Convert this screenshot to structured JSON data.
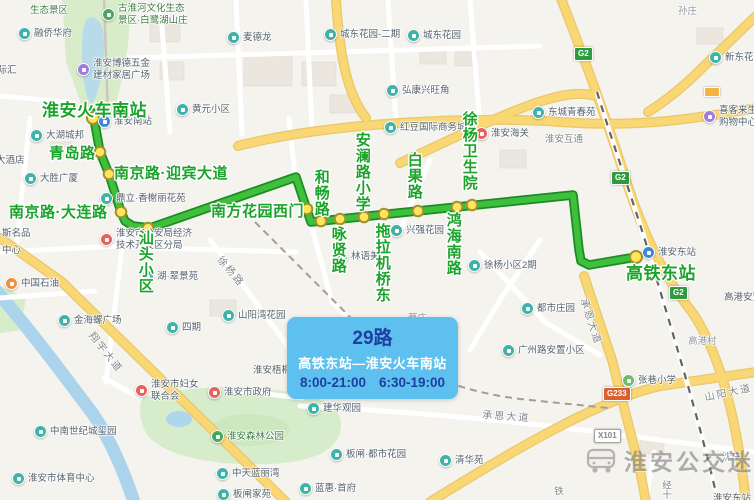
{
  "info_box": {
    "line_name": "29路",
    "route": "高铁东站—淮安火车南站",
    "hours_left": "8:00-21:00",
    "hours_right": "6:30-19:00"
  },
  "watermark": {
    "text": "淮安公交迷"
  },
  "map": {
    "route": {
      "color": "#3fbf3c",
      "casing": "#1a8c24",
      "stop_fill": "#ffe55c",
      "stop_border": "#a2922e",
      "path_points": [
        [
          93,
          113
        ],
        [
          100,
          152
        ],
        [
          109,
          174
        ],
        [
          121,
          212
        ],
        [
          125,
          221
        ],
        [
          133,
          226
        ],
        [
          150,
          228
        ],
        [
          296,
          177
        ],
        [
          311,
          222
        ],
        [
          573,
          195
        ],
        [
          579,
          250
        ],
        [
          581,
          261
        ],
        [
          589,
          265
        ],
        [
          636,
          257
        ]
      ],
      "stops": [
        {
          "name": "淮安火车南站",
          "x": 93,
          "y": 118
        },
        {
          "name": "青岛路",
          "x": 100,
          "y": 152
        },
        {
          "name": "南京路·迎宾大道",
          "x": 109,
          "y": 174
        },
        {
          "name": "南京路·大连路",
          "x": 121,
          "y": 212
        },
        {
          "name": "汕头小区",
          "x": 148,
          "y": 228
        },
        {
          "name": "南方花园西门",
          "x": 307,
          "y": 209
        },
        {
          "name": "和畅路",
          "x": 321,
          "y": 221
        },
        {
          "name": "咏贤路",
          "x": 340,
          "y": 219
        },
        {
          "name": "安澜路小学",
          "x": 364,
          "y": 217
        },
        {
          "name": "拖拉机桥东",
          "x": 384,
          "y": 214
        },
        {
          "name": "白果路",
          "x": 418,
          "y": 211
        },
        {
          "name": "鸿海南路",
          "x": 457,
          "y": 207
        },
        {
          "name": "徐杨卫生院",
          "x": 472,
          "y": 205
        },
        {
          "name": "高铁东站",
          "x": 636,
          "y": 257
        }
      ],
      "labels": [
        {
          "text": "淮安火车南站",
          "x": 42,
          "y": 96,
          "big": true
        },
        {
          "text": "青岛路",
          "x": 49,
          "y": 142
        },
        {
          "text": "南京路·迎宾大道",
          "x": 114,
          "y": 162
        },
        {
          "text": "南京路·大连路",
          "x": 9,
          "y": 201
        },
        {
          "text": "汕头小区",
          "x": 137,
          "y": 230,
          "vertical": true
        },
        {
          "text": "南方花园西门",
          "x": 211,
          "y": 200
        },
        {
          "text": "和畅路",
          "x": 313,
          "y": 169,
          "vertical": true
        },
        {
          "text": "咏贤路",
          "x": 330,
          "y": 226,
          "vertical": true
        },
        {
          "text": "安澜路小学",
          "x": 354,
          "y": 132,
          "vertical": true
        },
        {
          "text": "拖拉机桥东",
          "x": 374,
          "y": 223,
          "vertical": true
        },
        {
          "text": "白果路",
          "x": 406,
          "y": 152,
          "vertical": true
        },
        {
          "text": "鸿海南路",
          "x": 445,
          "y": 212,
          "vertical": true
        },
        {
          "text": "徐杨卫生院",
          "x": 461,
          "y": 111,
          "vertical": true
        },
        {
          "text": "高铁东站",
          "x": 626,
          "y": 259,
          "big": true
        }
      ]
    },
    "pois": [
      {
        "x": 108,
        "y": 15,
        "t": "park",
        "lines": [
          "古淮河文化生态",
          "景区·白鹭湖山庄"
        ]
      },
      {
        "x": 24,
        "y": 34,
        "t": "residential",
        "text": "融侨华府"
      },
      {
        "x": 233,
        "y": 38,
        "t": "residential",
        "text": "麦德龙"
      },
      {
        "x": 330,
        "y": 35,
        "t": "residential",
        "text": "城东花园-二期"
      },
      {
        "x": 413,
        "y": 36,
        "t": "residential",
        "text": "城东花园"
      },
      {
        "x": 83,
        "y": 70,
        "t": "mall",
        "lines": [
          "淮安博德五金",
          "建材家居广场"
        ]
      },
      {
        "x": 392,
        "y": 91,
        "t": "residential",
        "text": "弘康兴旺角"
      },
      {
        "x": 390,
        "y": 128,
        "t": "residential",
        "text": "红豆国际商务城"
      },
      {
        "x": 481,
        "y": 134,
        "t": "gov",
        "text": "淮安海关"
      },
      {
        "x": 538,
        "y": 113,
        "t": "residential",
        "text": "东城青春苑"
      },
      {
        "x": 715,
        "y": 58,
        "t": "residential",
        "text": "新东花园"
      },
      {
        "x": 709,
        "y": 117,
        "t": "mall",
        "lines": [
          "喜客来生",
          "购物中心"
        ]
      },
      {
        "x": 182,
        "y": 110,
        "t": "residential",
        "text": "黄元小区"
      },
      {
        "x": 104,
        "y": 122,
        "t": "transit",
        "text": "淮安南站"
      },
      {
        "x": 36,
        "y": 136,
        "t": "residential",
        "text": "大湖城邦"
      },
      {
        "x": 30,
        "y": 179,
        "t": "residential",
        "text": "大胜广厦"
      },
      {
        "x": 106,
        "y": 199,
        "t": "residential",
        "text": "鼎立·香榭丽花苑"
      },
      {
        "x": 106,
        "y": 240,
        "t": "gov",
        "lines": [
          "淮安市公安局经济",
          "技术开发区分局"
        ]
      },
      {
        "x": -8,
        "y": 234,
        "t": "mall",
        "text": "斯名品"
      },
      {
        "x": 147,
        "y": 277,
        "t": "residential",
        "text": "湖·翠景苑"
      },
      {
        "x": 11,
        "y": 284,
        "t": "gas",
        "text": "中国石油"
      },
      {
        "x": 396,
        "y": 231,
        "t": "residential",
        "text": "兴强花园"
      },
      {
        "x": 341,
        "y": 257,
        "t": "residential",
        "text": "林语美"
      },
      {
        "x": 474,
        "y": 266,
        "t": "residential",
        "text": "徐杨小区2期"
      },
      {
        "x": 172,
        "y": 328,
        "t": "residential",
        "text": "四期"
      },
      {
        "x": 228,
        "y": 316,
        "t": "residential",
        "text": "山阳湾花园"
      },
      {
        "x": 64,
        "y": 321,
        "t": "residential",
        "text": "金海螺广场"
      },
      {
        "x": 141,
        "y": 391,
        "t": "gov",
        "lines": [
          "淮安市妇女",
          "联合会"
        ]
      },
      {
        "x": 214,
        "y": 393,
        "t": "gov",
        "text": "淮安市政府"
      },
      {
        "x": 40,
        "y": 432,
        "t": "residential",
        "text": "中南世纪城玺园"
      },
      {
        "x": 18,
        "y": 479,
        "t": "residential",
        "text": "淮安市体育中心"
      },
      {
        "x": 217,
        "y": 437,
        "t": "park",
        "text": "淮安森林公园"
      },
      {
        "x": 313,
        "y": 409,
        "t": "residential",
        "text": "建华观园"
      },
      {
        "x": 222,
        "y": 474,
        "t": "residential",
        "text": "中天蓝丽湾"
      },
      {
        "x": 336,
        "y": 455,
        "t": "residential",
        "text": "板闸·都市花园"
      },
      {
        "x": 305,
        "y": 489,
        "t": "residential",
        "text": "蓝惠·首府"
      },
      {
        "x": 223,
        "y": 495,
        "t": "residential",
        "text": "板闸家苑"
      },
      {
        "x": 527,
        "y": 309,
        "t": "residential",
        "text": "都市庄园"
      },
      {
        "x": 508,
        "y": 351,
        "t": "residential",
        "text": "广州路安置小区"
      },
      {
        "x": 628,
        "y": 381,
        "t": "school",
        "text": "张巷小学"
      },
      {
        "x": 445,
        "y": 461,
        "t": "residential",
        "text": "清华苑"
      },
      {
        "x": 648,
        "y": 253,
        "t": "transit",
        "text": "淮安东站"
      }
    ],
    "plain_labels": [
      {
        "x": 30,
        "y": 2,
        "text": "生态景区",
        "c": "park"
      },
      {
        "x": -12,
        "y": 62,
        "text": "国际汇"
      },
      {
        "x": -4,
        "y": 152,
        "text": "大酒店"
      },
      {
        "x": 2,
        "y": 242,
        "text": "中心"
      },
      {
        "x": 253,
        "y": 362,
        "text": "淮安梧桐"
      },
      {
        "x": 545,
        "y": 131,
        "text": "淮安互通",
        "c": "road"
      },
      {
        "x": 688,
        "y": 333,
        "text": "高港村",
        "c": "village"
      },
      {
        "x": 724,
        "y": 289,
        "text": "高港安置小区"
      },
      {
        "x": 408,
        "y": 310,
        "text": "蔡庄",
        "c": "village"
      },
      {
        "x": 722,
        "y": 449,
        "text": "沈庄",
        "c": "village"
      },
      {
        "x": 678,
        "y": 3,
        "text": "孙庄",
        "c": "village"
      },
      {
        "x": 713,
        "y": 490,
        "text": "淮安东站"
      },
      {
        "x": 660,
        "y": 480,
        "text": "经十",
        "c": "road",
        "vertical": true
      },
      {
        "x": 552,
        "y": 486,
        "text": "铁",
        "c": "road",
        "vertical": true
      }
    ],
    "road_labels": [
      {
        "x": 226,
        "y": 252,
        "text": "徐杨路",
        "angle": 50
      },
      {
        "x": 98,
        "y": 328,
        "text": "翔宇大道",
        "angle": 52
      },
      {
        "x": 592,
        "y": 296,
        "text": "承恩大道",
        "angle": 72
      },
      {
        "x": 483,
        "y": 406,
        "text": "承恩大道",
        "angle": 4
      },
      {
        "x": 703,
        "y": 389,
        "text": "山阳大道",
        "angle": -12
      }
    ],
    "badges": [
      {
        "x": 574,
        "y": 47,
        "text": "G2",
        "type": "g"
      },
      {
        "x": 611,
        "y": 171,
        "text": "G2",
        "type": "g"
      },
      {
        "x": 669,
        "y": 286,
        "text": "G2",
        "type": "g"
      },
      {
        "x": 603,
        "y": 387,
        "text": "G233",
        "type": "g233"
      },
      {
        "x": 594,
        "y": 429,
        "text": "X101",
        "type": "x"
      },
      {
        "x": 704,
        "y": 87,
        "text": "",
        "type": "service"
      }
    ]
  }
}
